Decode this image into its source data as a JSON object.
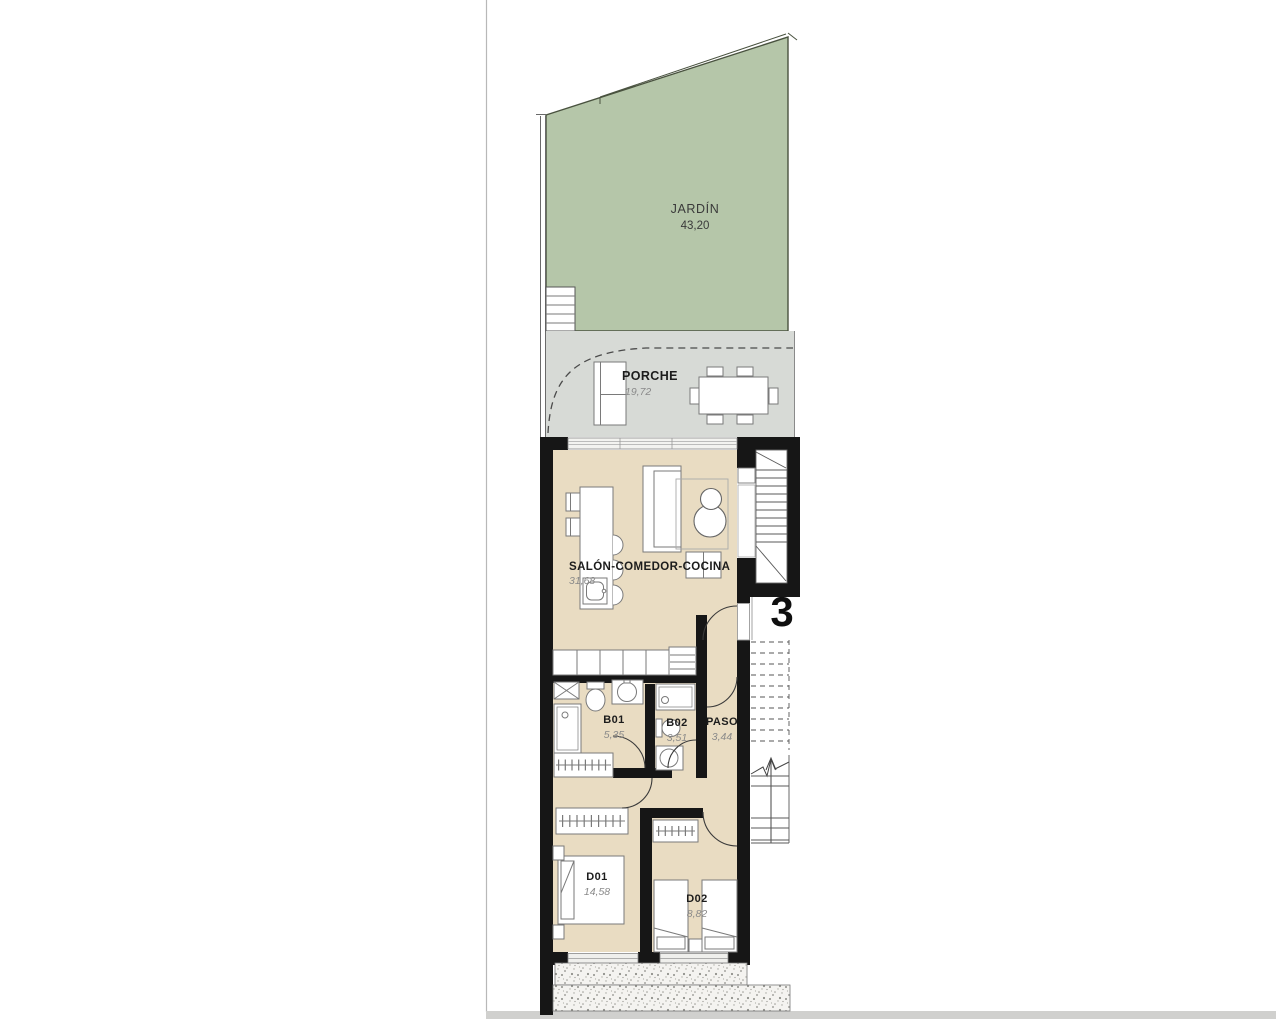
{
  "plan": {
    "unit_number": "3",
    "rooms": {
      "jardin": {
        "label": "JARDÍN",
        "area": "43,20"
      },
      "porche": {
        "label": "PORCHE",
        "area": "19,72"
      },
      "salon": {
        "label": "SALÓN-COMEDOR-COCINA",
        "area": "31,68"
      },
      "b01": {
        "label": "B01",
        "area": "5,35"
      },
      "b02": {
        "label": "B02",
        "area": "3,51"
      },
      "paso": {
        "label": "PASO",
        "area": "3,44"
      },
      "d01": {
        "label": "D01",
        "area": "14,58"
      },
      "d02": {
        "label": "D02",
        "area": "8,82"
      }
    },
    "colors": {
      "garden": "#b5c6a9",
      "garden_edge": "#49523f",
      "porch": "#d7dad6",
      "floor": "#e9dcc2",
      "wall": "#161616",
      "paper_line": "#b8b8b8",
      "paper_band": "#d0d0ce"
    }
  }
}
